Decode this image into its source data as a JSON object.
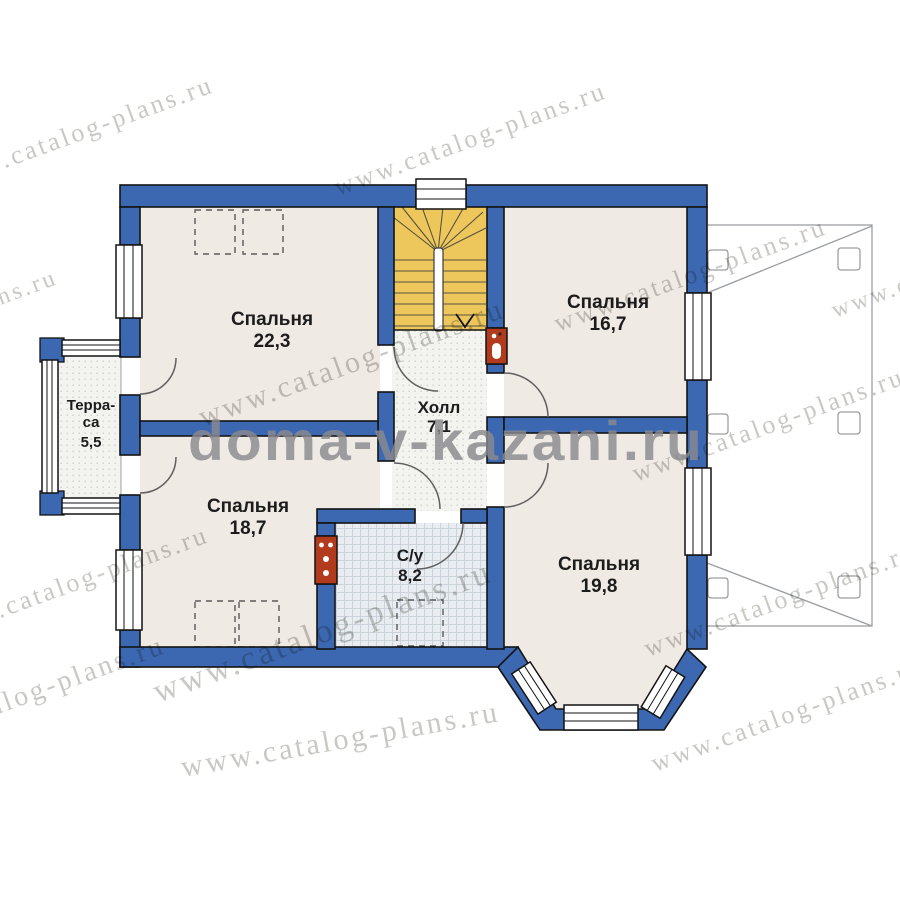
{
  "title": "Floor plan of second level with room areas",
  "watermarks": {
    "large": "doma-v-kazani.ru",
    "tile": "www.catalog-plans.ru"
  },
  "rooms": [
    {
      "name": "Спальня",
      "area": "22,3"
    },
    {
      "name": "Спальня",
      "area": "16,7"
    },
    {
      "name": "Холл",
      "area": "7,1"
    },
    {
      "name": "Спальня",
      "area": "18,7"
    },
    {
      "name": "С/у",
      "area": "8,2"
    },
    {
      "name": "Спальня",
      "area": "19,8"
    }
  ],
  "terrace": {
    "line1": "Терра-",
    "line2": "са",
    "area": "5,5"
  },
  "colors": {
    "wall_blue": "#3c68b2",
    "stairs_yellow": "#edc75c",
    "floor_pink": "#f0eae4",
    "flue_red": "#b23b1e",
    "watermark_gray": "#8a8a8e"
  }
}
